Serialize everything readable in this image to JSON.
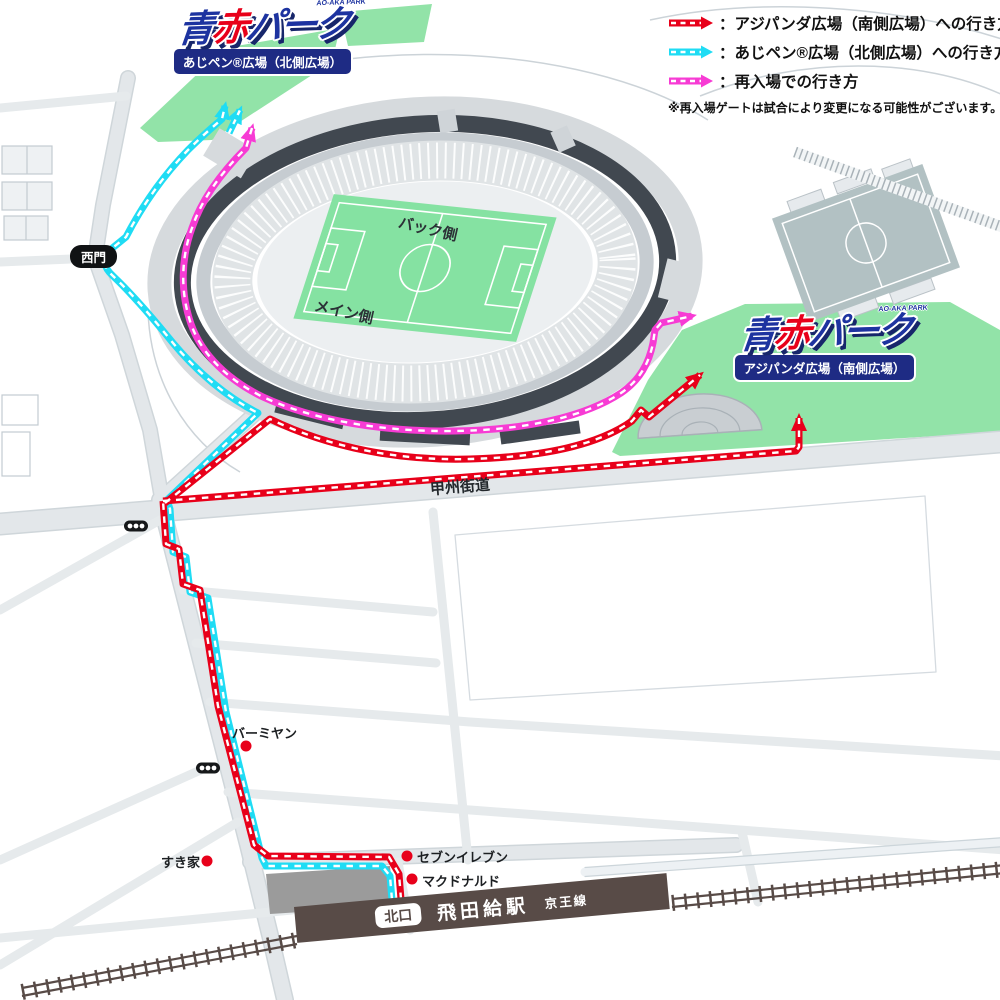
{
  "legend": {
    "items": [
      {
        "label": "：アジパンダ広場（南側広場）への行き方",
        "color": "#e8001a"
      },
      {
        "label": "：あじペン®広場（北側広場）への行き方",
        "color": "#1fdcf4"
      },
      {
        "label": "：再入場での行き方",
        "color": "#f73bd4"
      }
    ],
    "note": "※再入場ゲートは試合により変更になる可能性がございます。"
  },
  "logo": {
    "ao": "青",
    "aka": "赤",
    "park": "パーク",
    "badge": "AO-AKA PARK"
  },
  "plazas": {
    "north": {
      "label": "あじペン®広場（北側広場）"
    },
    "south": {
      "label": "アジパンダ広場（南側広場）"
    }
  },
  "stadium": {
    "back_stand": "バック側",
    "main_stand": "メイン側",
    "west_gate": "西門"
  },
  "roads": {
    "koshu_kaido": "甲州街道"
  },
  "landmarks": [
    {
      "name": "バーミヤン"
    },
    {
      "name": "すき家"
    },
    {
      "name": "セブンイレブン"
    },
    {
      "name": "マクドナルド"
    }
  ],
  "station": {
    "exit": "北口",
    "name": "飛田給駅",
    "line": "京王線"
  },
  "colors": {
    "route_south": "#e8001a",
    "route_north": "#1fdcf4",
    "route_reentry": "#f73bd4",
    "plaza_green": "#92e3a8",
    "pitch_green": "#85e2a2",
    "aux_field_gray": "#b2c1c3",
    "stadium_dark": "#414850",
    "road_gray": "#e3e7ea",
    "station_brown": "#584b47",
    "label_navy": "#1e2b84",
    "logo_blue": "#1d33a0"
  }
}
